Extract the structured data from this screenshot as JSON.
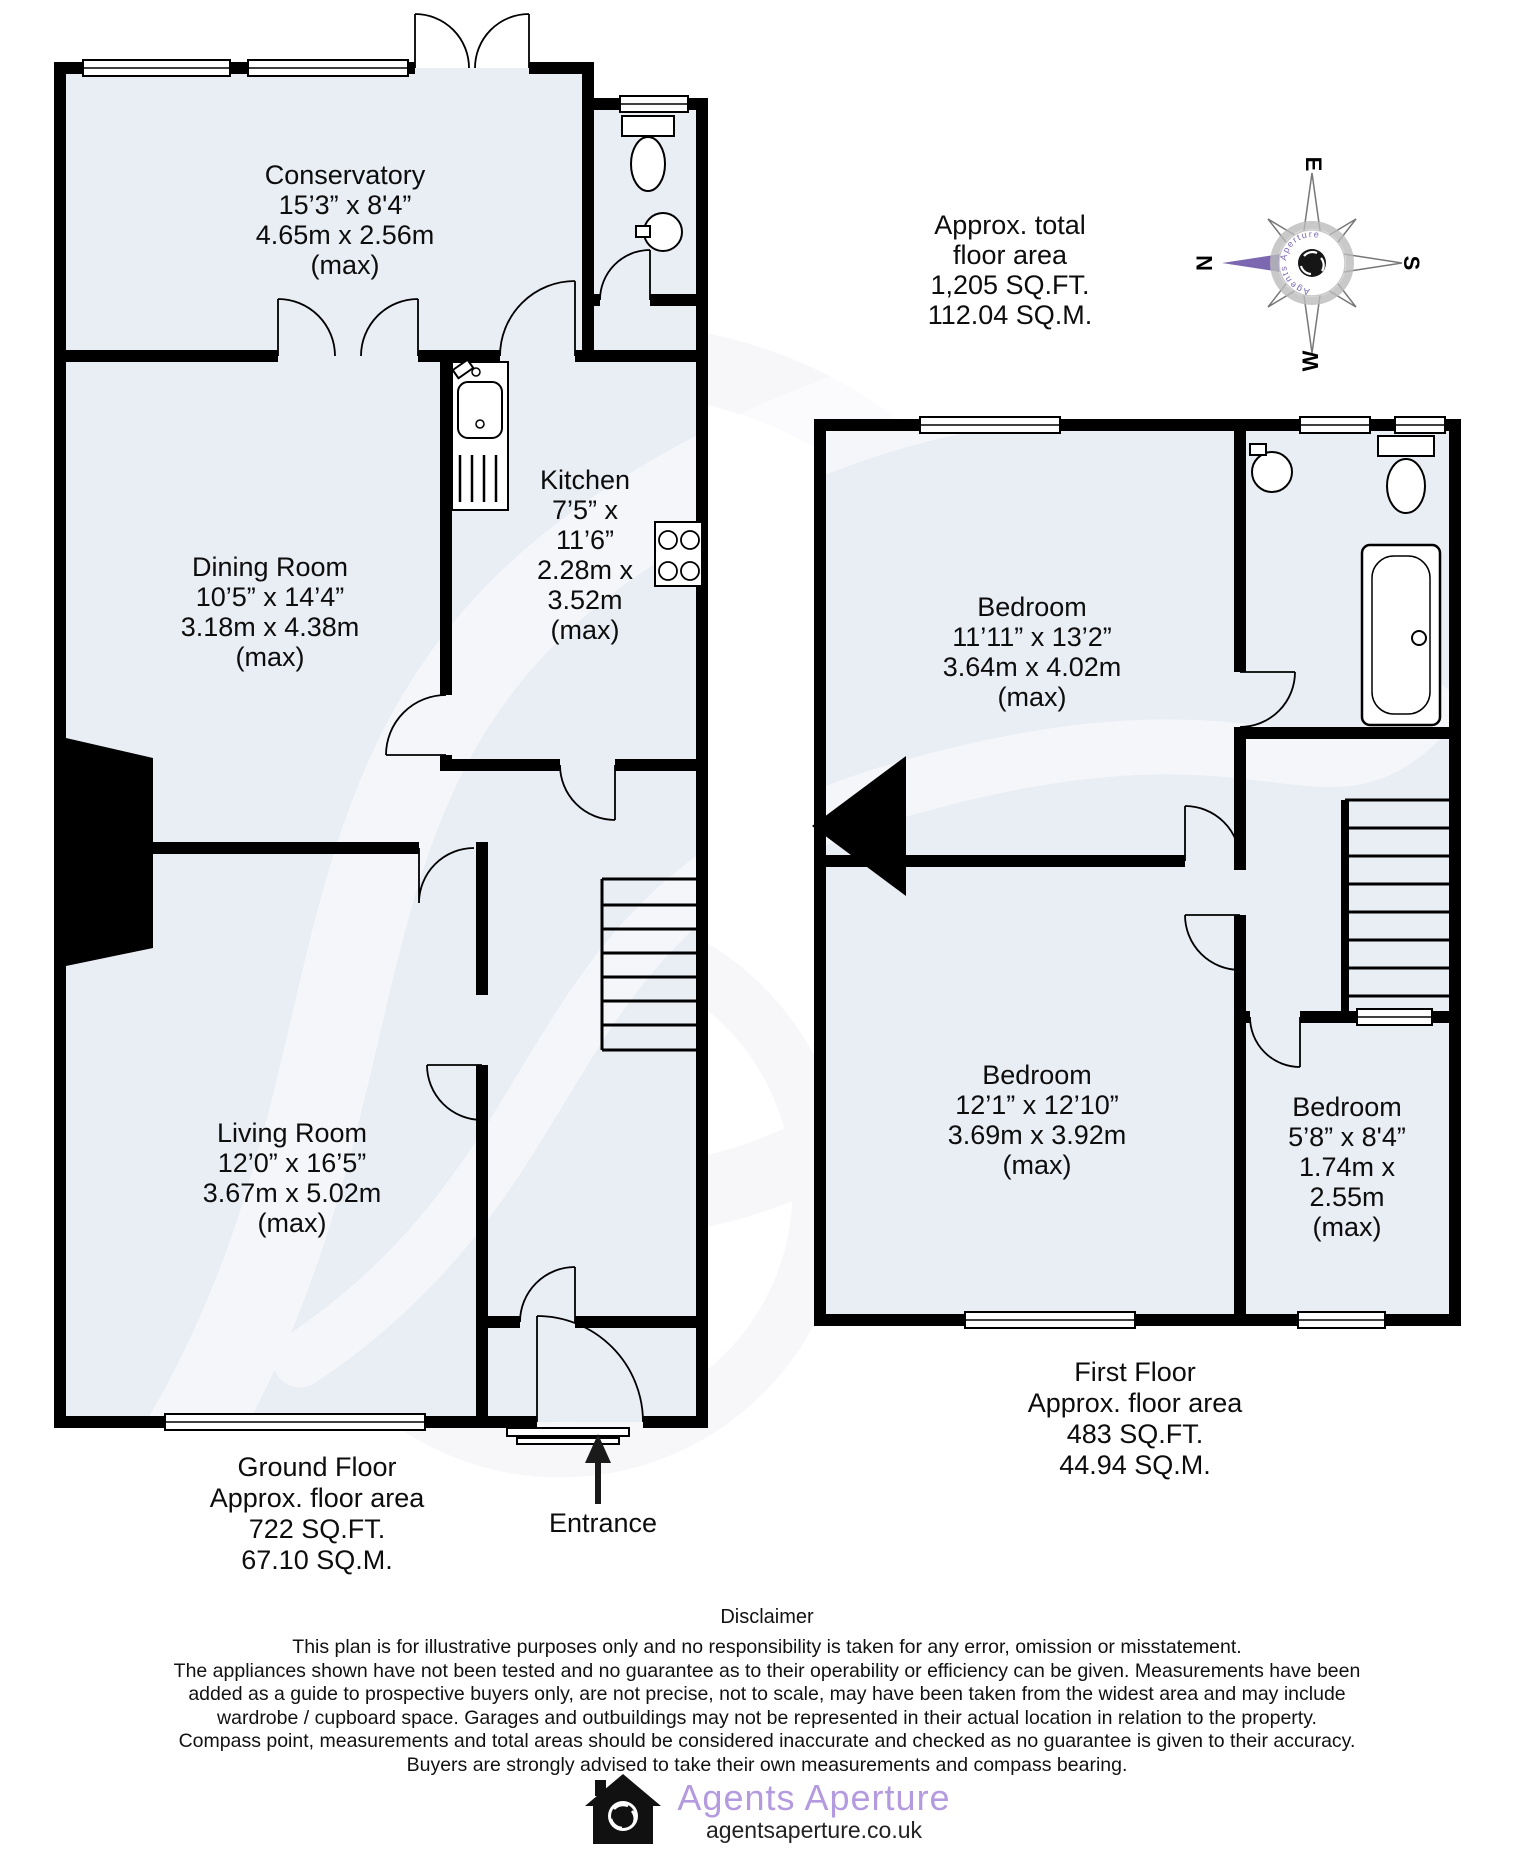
{
  "total_area": {
    "lines": [
      "Approx. total",
      "floor area",
      "1,205 SQ.FT.",
      "112.04 SQ.M."
    ]
  },
  "compass": {
    "n": "N",
    "e": "E",
    "s": "S",
    "w": "W",
    "brand": "Agents Aperture",
    "arrow_color": "#7b68b0"
  },
  "ground_floor": {
    "rooms": {
      "conservatory": {
        "lines": [
          "Conservatory",
          "15’3” x 8'4”",
          "4.65m x 2.56m",
          "(max)"
        ]
      },
      "dining": {
        "lines": [
          "Dining Room",
          "10’5” x 14’4”",
          "3.18m x 4.38m",
          "(max)"
        ]
      },
      "kitchen": {
        "lines": [
          "Kitchen",
          "7’5” x",
          "11’6”",
          "2.28m x",
          "3.52m",
          "(max)"
        ]
      },
      "living": {
        "lines": [
          "Living Room",
          "12’0” x 16’5”",
          "3.67m x 5.02m",
          "(max)"
        ]
      }
    },
    "caption": {
      "lines": [
        "Ground Floor",
        "Approx. floor area",
        "722 SQ.FT.",
        "67.10 SQ.M."
      ]
    },
    "entrance_label": "Entrance"
  },
  "first_floor": {
    "rooms": {
      "bedroom1": {
        "lines": [
          "Bedroom",
          "11’11” x 13’2”",
          "3.64m x 4.02m",
          "(max)"
        ]
      },
      "bedroom2": {
        "lines": [
          "Bedroom",
          "12’1” x 12’10”",
          "3.69m x 3.92m",
          "(max)"
        ]
      },
      "bedroom3": {
        "lines": [
          "Bedroom",
          "5’8” x 8'4”",
          "1.74m x",
          "2.55m",
          "(max)"
        ]
      }
    },
    "caption": {
      "lines": [
        "First Floor",
        "Approx. floor area",
        "483 SQ.FT.",
        "44.94 SQ.M."
      ]
    }
  },
  "disclaimer": {
    "title": "Disclaimer",
    "lines": [
      "This plan is for illustrative purposes only and no responsibility is taken for any error, omission or misstatement.",
      "The appliances shown have not been tested and no guarantee as to their operability or efficiency can be given. Measurements have been",
      "added as a guide to prospective buyers only, are not precise, not to scale, may have been taken from the widest area and may include",
      "wardrobe / cupboard space. Garages and outbuildings may not be represented in their actual location in relation to the property.",
      "Compass point, measurements and total areas should be considered inaccurate and checked as no guarantee is given to their accuracy.",
      "Buyers are strongly advised to take their own measurements and compass bearing."
    ]
  },
  "footer": {
    "brand": "Agents Aperture",
    "url": "agentsaperture.co.uk",
    "brand_color": "#b49ade"
  }
}
